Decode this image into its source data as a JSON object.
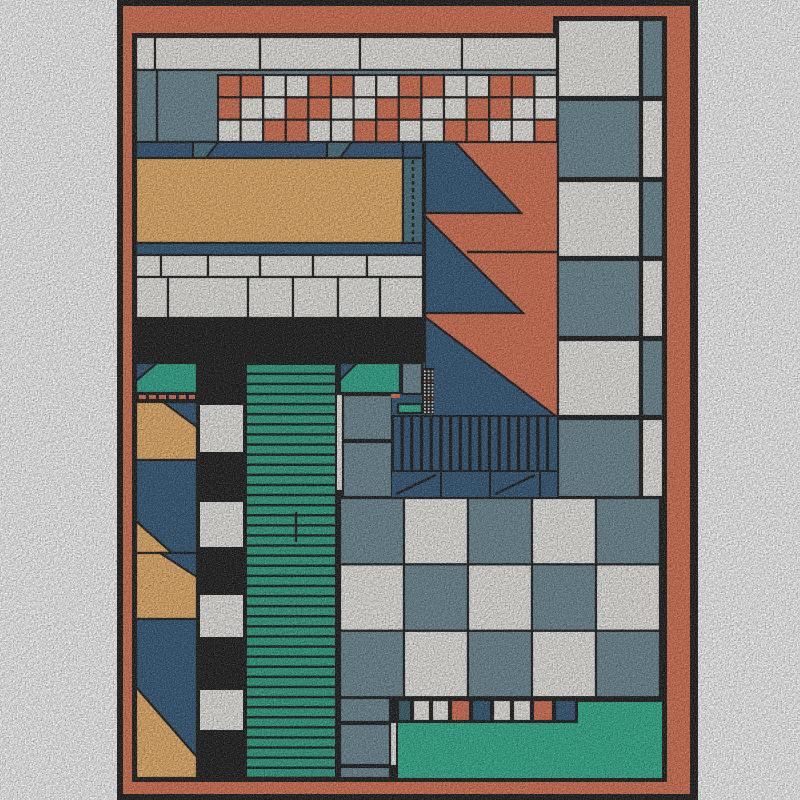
{
  "artwork": {
    "kind": "abstract-geometric-rug",
    "canvas": {
      "width": 800,
      "height": 800,
      "margin_color": "#ffffff"
    },
    "palette": {
      "coral": "#dc7150",
      "tan": "#eeb168",
      "slate": "#6b8894",
      "navy": "#2f5577",
      "accent": "#45707f",
      "teal": "#2aa98c",
      "stripe_teal": "#2aa183",
      "bright_teal": "#2db28e",
      "dark_teal": "#33606b",
      "white": "#efeee9",
      "black": "#181818",
      "outline": "#191919"
    },
    "shapes": [
      {
        "n": "outer-black-frame",
        "t": "rect",
        "r": [
          117,
          0,
          581,
          800
        ],
        "f": "black",
        "s": false
      },
      {
        "n": "orange-border",
        "t": "rect",
        "r": [
          123,
          6,
          567,
          788
        ],
        "f": "coral",
        "s": false
      },
      {
        "n": "content-bg-left",
        "t": "rect",
        "r": [
          132,
          33,
          435,
          749
        ],
        "f": "black",
        "s": false
      },
      {
        "n": "content-bg-right",
        "t": "rect",
        "r": [
          553,
          16,
          114,
          766
        ],
        "f": "black",
        "s": false
      },
      {
        "n": "top-white-strip-row",
        "t": "cells1d",
        "y": 37,
        "h": 33,
        "bounds": [
          136,
          155,
          260,
          360,
          462,
          557
        ],
        "f": "white"
      },
      {
        "n": "top-slate-band",
        "t": "rect",
        "r": [
          136,
          70,
          421,
          72
        ],
        "f": "slate"
      },
      {
        "n": "top-slate-band-divider",
        "t": "line",
        "p": [
          157,
          70,
          157,
          141
        ]
      },
      {
        "n": "top-checker-band",
        "t": "grid",
        "x": 218,
        "y": 75,
        "cw": 22.6,
        "ch": 22.35,
        "rows": [
          "ccwwccwwccwwccw",
          "cwwccwwccwwccww",
          "wwccwwccwwccwwc"
        ],
        "map": {
          "c": "coral",
          "w": "white"
        }
      },
      {
        "n": "navy-band",
        "t": "rect",
        "r": [
          136,
          142,
          289,
          16
        ],
        "f": "navy"
      },
      {
        "n": "band-trapezoid-1",
        "t": "poly",
        "pts": [
          [
            193,
            142
          ],
          [
            218,
            142
          ],
          [
            206,
            158
          ],
          [
            193,
            158
          ]
        ],
        "f": "accent"
      },
      {
        "n": "band-trapezoid-2",
        "t": "poly",
        "pts": [
          [
            327,
            142
          ],
          [
            352,
            142
          ],
          [
            340,
            158
          ],
          [
            327,
            158
          ]
        ],
        "f": "accent"
      },
      {
        "n": "tan-panel",
        "t": "rect",
        "r": [
          136,
          158,
          267,
          85
        ],
        "f": "tan"
      },
      {
        "n": "dash-strip-cap",
        "t": "rect",
        "r": [
          403,
          142,
          20,
          16
        ],
        "f": "navy"
      },
      {
        "n": "dash-strip",
        "t": "rect",
        "r": [
          403,
          158,
          20,
          97
        ],
        "f": "accent"
      },
      {
        "n": "dash-strip-line",
        "t": "line",
        "p": [
          413,
          160,
          413,
          252
        ],
        "dash": "4 3"
      },
      {
        "n": "navy-underband",
        "t": "rect",
        "r": [
          136,
          243,
          287,
          12
        ],
        "f": "navy"
      },
      {
        "n": "brick-row-a",
        "t": "cells1d",
        "y": 255,
        "h": 22,
        "bounds": [
          136,
          161,
          208,
          260,
          313,
          367,
          423
        ],
        "f": "white"
      },
      {
        "n": "brick-row-b",
        "t": "cells1d",
        "y": 277,
        "h": 41,
        "bounds": [
          136,
          168,
          248,
          293,
          338,
          380,
          423
        ],
        "f": "white"
      },
      {
        "n": "coral-field",
        "t": "rect",
        "r": [
          425,
          142,
          133,
          275
        ],
        "f": "coral"
      },
      {
        "n": "sawtooth-1",
        "t": "poly",
        "pts": [
          [
            425,
            142
          ],
          [
            455,
            142
          ],
          [
            521,
            213
          ],
          [
            425,
            213
          ]
        ],
        "f": "navy"
      },
      {
        "n": "sawtooth-2",
        "t": "poly",
        "pts": [
          [
            425,
            216
          ],
          [
            523,
            313
          ],
          [
            425,
            313
          ]
        ],
        "f": "navy"
      },
      {
        "n": "sawtooth-3",
        "t": "poly",
        "pts": [
          [
            425,
            317
          ],
          [
            557,
            417
          ],
          [
            425,
            417
          ]
        ],
        "f": "navy"
      },
      {
        "n": "coral-field-seam",
        "t": "line",
        "p": [
          467,
          252,
          557,
          252
        ]
      },
      {
        "n": "rcol-r1-big",
        "t": "rect",
        "r": [
          558,
          20,
          82,
          77
        ],
        "f": "white"
      },
      {
        "n": "rcol-r1-strip",
        "t": "rect",
        "r": [
          642,
          20,
          21,
          77
        ],
        "f": "slate"
      },
      {
        "n": "rcol-r2-big",
        "t": "rect",
        "r": [
          558,
          100,
          82,
          78
        ],
        "f": "slate"
      },
      {
        "n": "rcol-r2-strip",
        "t": "rect",
        "r": [
          642,
          100,
          21,
          78
        ],
        "f": "white"
      },
      {
        "n": "rcol-r3-big",
        "t": "rect",
        "r": [
          558,
          181,
          82,
          76
        ],
        "f": "white"
      },
      {
        "n": "rcol-r3-strip",
        "t": "rect",
        "r": [
          642,
          181,
          21,
          76
        ],
        "f": "slate"
      },
      {
        "n": "rcol-r4-big",
        "t": "rect",
        "r": [
          558,
          260,
          82,
          77
        ],
        "f": "slate"
      },
      {
        "n": "rcol-r4-strip",
        "t": "rect",
        "r": [
          642,
          260,
          21,
          77
        ],
        "f": "white"
      },
      {
        "n": "rcol-r5-big",
        "t": "rect",
        "r": [
          558,
          340,
          82,
          76
        ],
        "f": "white"
      },
      {
        "n": "rcol-r5-strip",
        "t": "rect",
        "r": [
          642,
          340,
          21,
          76
        ],
        "f": "slate"
      },
      {
        "n": "rcol-r6-big",
        "t": "rect",
        "r": [
          558,
          419,
          82,
          78
        ],
        "f": "slate"
      },
      {
        "n": "rcol-r6-strip",
        "t": "rect",
        "r": [
          642,
          419,
          21,
          78
        ],
        "f": "white"
      },
      {
        "n": "left-teal-block",
        "t": "rect",
        "r": [
          136,
          363,
          61,
          30
        ],
        "f": "teal"
      },
      {
        "n": "left-teal-corner",
        "t": "poly",
        "pts": [
          [
            136,
            363
          ],
          [
            157,
            363
          ],
          [
            136,
            381
          ]
        ],
        "f": "navy"
      },
      {
        "n": "left-dash-row-bg",
        "t": "rect",
        "r": [
          136,
          393,
          61,
          9
        ],
        "f": "black",
        "s": false
      },
      {
        "n": "left-dash-row",
        "t": "items1d",
        "y": 395,
        "h": 4,
        "items": [
          [
            139,
            7
          ],
          [
            149,
            7
          ],
          [
            159,
            7
          ],
          [
            169,
            7
          ],
          [
            179,
            7
          ],
          [
            189,
            6
          ]
        ],
        "f": "coral",
        "s": false
      },
      {
        "n": "left-tan-1",
        "t": "rect",
        "r": [
          136,
          402,
          61,
          58
        ],
        "f": "tan"
      },
      {
        "n": "left-tan-1-corner",
        "t": "poly",
        "pts": [
          [
            163,
            402
          ],
          [
            197,
            402
          ],
          [
            197,
            427
          ]
        ],
        "f": "navy"
      },
      {
        "n": "left-navy-1",
        "t": "rect",
        "r": [
          136,
          460,
          61,
          93
        ],
        "f": "navy"
      },
      {
        "n": "left-navy-1-corner",
        "t": "poly",
        "pts": [
          [
            136,
            521
          ],
          [
            136,
            553
          ],
          [
            172,
            553
          ]
        ],
        "f": "tan"
      },
      {
        "n": "left-tan-2",
        "t": "rect",
        "r": [
          136,
          553,
          61,
          66
        ],
        "f": "tan"
      },
      {
        "n": "left-tan-2-corner",
        "t": "poly",
        "pts": [
          [
            160,
            553
          ],
          [
            197,
            553
          ],
          [
            197,
            577
          ]
        ],
        "f": "navy"
      },
      {
        "n": "left-navy-2",
        "t": "rect",
        "r": [
          136,
          619,
          61,
          159
        ],
        "f": "navy"
      },
      {
        "n": "left-tan-bottom",
        "t": "poly",
        "pts": [
          [
            136,
            687
          ],
          [
            197,
            757
          ],
          [
            197,
            778
          ],
          [
            136,
            778
          ]
        ],
        "f": "tan"
      },
      {
        "n": "checker-col-sq1",
        "t": "rect",
        "r": [
          200,
          405,
          43,
          47
        ],
        "f": "white",
        "s": false
      },
      {
        "n": "checker-col-sq2",
        "t": "rect",
        "r": [
          200,
          502,
          43,
          45
        ],
        "f": "white",
        "s": false
      },
      {
        "n": "checker-col-sq3",
        "t": "rect",
        "r": [
          200,
          595,
          43,
          42
        ],
        "f": "white",
        "s": false
      },
      {
        "n": "checker-col-sq4",
        "t": "rect",
        "r": [
          200,
          690,
          43,
          40
        ],
        "f": "white",
        "s": false
      },
      {
        "n": "stripe-column-bg",
        "t": "rect",
        "r": [
          246,
          363,
          90,
          415
        ],
        "f": "black",
        "s": false
      },
      {
        "n": "stripe-column",
        "t": "stripes",
        "dir": "h",
        "x": 247,
        "y": 365,
        "count": 41,
        "pitch": 10.1,
        "thick": 7.6,
        "len": 88,
        "f": "stripe_teal"
      },
      {
        "n": "stripe-seam",
        "t": "line",
        "p": [
          296,
          512,
          296,
          542
        ]
      },
      {
        "n": "mid-white-strip",
        "t": "rect",
        "r": [
          337,
          395,
          7,
          95
        ],
        "f": "white",
        "s": false
      },
      {
        "n": "mid-slate-1",
        "t": "rect",
        "r": [
          343,
          395,
          49,
          45
        ],
        "f": "slate"
      },
      {
        "n": "mid-slate-2",
        "t": "rect",
        "r": [
          343,
          442,
          49,
          55
        ],
        "f": "slate"
      },
      {
        "n": "stair-navy-left",
        "t": "rect",
        "r": [
          392,
          363,
          33,
          54
        ],
        "f": "navy",
        "s": false
      },
      {
        "n": "stair-slate-block",
        "t": "rect",
        "r": [
          402,
          363,
          20,
          31
        ],
        "f": "slate"
      },
      {
        "n": "stair-teal-block",
        "t": "rect",
        "r": [
          340,
          363,
          60,
          30
        ],
        "f": "teal"
      },
      {
        "n": "stair-teal-corner",
        "t": "poly",
        "pts": [
          [
            340,
            363
          ],
          [
            357,
            363
          ],
          [
            340,
            380
          ]
        ],
        "f": "navy"
      },
      {
        "n": "stair-orange-dash",
        "t": "rect",
        "r": [
          391,
          394,
          9,
          4
        ],
        "f": "coral",
        "s": false
      },
      {
        "n": "stair-teal-bar",
        "t": "rect",
        "r": [
          398,
          404,
          24,
          9
        ],
        "f": "bright_teal"
      },
      {
        "n": "dot-block-bg",
        "t": "rect",
        "r": [
          422,
          368,
          12,
          46
        ],
        "f": "black",
        "s": false
      },
      {
        "n": "dot-block",
        "t": "dots",
        "x": 424,
        "y": 370.5,
        "cols": 3,
        "rowsN": 13,
        "px": 3.8,
        "py": 3.4,
        "size": 1.8,
        "f": "white",
        "accent_rows": [
          3,
          8
        ],
        "af": "coral"
      },
      {
        "n": "comb-bg",
        "t": "rect",
        "r": [
          392,
          415,
          166,
          57
        ],
        "f": "black",
        "s": false
      },
      {
        "n": "comb-bars",
        "t": "stripes",
        "dir": "v",
        "x": 394,
        "y": 417,
        "count": 16,
        "pitch": 9.7,
        "thick": 6.5,
        "len": 53,
        "f": "navy"
      },
      {
        "n": "comb-bar-end",
        "t": "rect",
        "r": [
          549,
          417,
          8,
          53
        ],
        "f": "navy",
        "s": false
      },
      {
        "n": "comb-panel-1",
        "t": "rect",
        "r": [
          392,
          472,
          48,
          25
        ],
        "f": "navy",
        "s": false
      },
      {
        "n": "comb-panel-2",
        "t": "rect",
        "r": [
          442,
          472,
          47,
          25
        ],
        "f": "navy",
        "s": false
      },
      {
        "n": "comb-panel-3",
        "t": "rect",
        "r": [
          491,
          472,
          48,
          25
        ],
        "f": "navy",
        "s": false
      },
      {
        "n": "comb-panel-4",
        "t": "rect",
        "r": [
          541,
          472,
          16,
          25
        ],
        "f": "navy",
        "s": false
      },
      {
        "n": "comb-panel-diag-1",
        "t": "line",
        "p": [
          396,
          494,
          436,
          475
        ]
      },
      {
        "n": "comb-panel-diag-2",
        "t": "line",
        "p": [
          495,
          494,
          535,
          475
        ]
      },
      {
        "n": "checkerboard",
        "t": "grid",
        "x": 340,
        "y": 498,
        "cw": 64,
        "ch": 66.4,
        "rows": [
          "swsws",
          "wswsw",
          "swsws"
        ],
        "map": {
          "s": "slate",
          "w": "white"
        }
      },
      {
        "n": "bottom-tiles-row",
        "t": "items1d",
        "y": 700,
        "h": 21,
        "items": [
          [
            398,
            13,
            "dark_teal"
          ],
          [
            413,
            17,
            "white"
          ],
          [
            432,
            17,
            "white"
          ],
          [
            451,
            19,
            "coral"
          ],
          [
            472,
            19,
            "navy"
          ],
          [
            493,
            18,
            "white"
          ],
          [
            513,
            18,
            "white"
          ],
          [
            533,
            20,
            "coral"
          ],
          [
            555,
            21,
            "navy"
          ]
        ]
      },
      {
        "n": "bottom-teal-main",
        "t": "rect",
        "r": [
          398,
          723,
          264,
          55
        ],
        "f": "bright_teal",
        "s": false
      },
      {
        "n": "bottom-teal-step",
        "t": "rect",
        "r": [
          578,
          702,
          84,
          22
        ],
        "f": "bright_teal",
        "s": false
      },
      {
        "n": "bottom-white-dash",
        "t": "rect",
        "r": [
          390,
          723,
          6,
          42
        ],
        "f": "white",
        "s": false
      },
      {
        "n": "bl-slate-1",
        "t": "rect",
        "r": [
          340,
          698,
          50,
          24
        ],
        "f": "slate"
      },
      {
        "n": "bl-slate-2",
        "t": "rect",
        "r": [
          340,
          724,
          50,
          41
        ],
        "f": "slate"
      },
      {
        "n": "bl-slate-3",
        "t": "rect",
        "r": [
          340,
          767,
          50,
          11
        ],
        "f": "slate"
      }
    ]
  }
}
